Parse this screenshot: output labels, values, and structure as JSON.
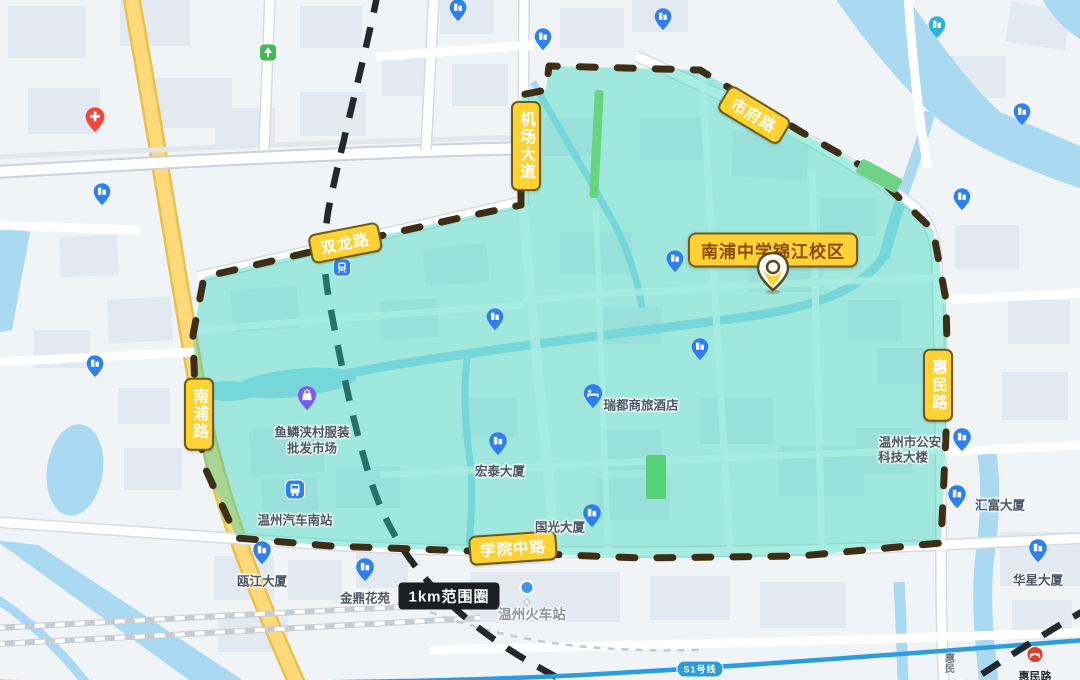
{
  "school": {
    "label": "南浦中学锦江校区"
  },
  "radius": {
    "label": "1km范围圈"
  },
  "roads": {
    "shuanglong": "双龙路",
    "jichang_dadao": "机场大道",
    "shifu": "市府路",
    "nanpu": "南浦路",
    "huimin": "惠民路",
    "xueyuan_zhong": "学院中路"
  },
  "pois": {
    "market_line1": "鱼鳞浃村服装",
    "market_line2": "批发市场",
    "bus_station": "温州汽车南站",
    "hotel": "瑞都商旅酒店",
    "hongtai": "宏泰大厦",
    "guoguang": "国光大厦",
    "police_line1": "温州市公安",
    "police_line2": "科技大楼",
    "huifu": "汇富大厦",
    "huaxing": "华星大厦",
    "oujiang": "瓯江大厦",
    "jinding": "金鼎花苑",
    "train_station": "温州火车站"
  },
  "transit": {
    "s1_line": "S1号线",
    "huimin_station": "惠民路",
    "huimin_road_text": "惠民"
  },
  "icons": {
    "school_marker": "yellow-location-pin",
    "hospital": "red-cross-pin",
    "hotel": "bed-pin",
    "market": "shopping-bag-pin",
    "bus_station": "bus-square",
    "building": "building-pin",
    "park": "tree-square",
    "metro_station": "red-metro-logo",
    "train_station": "blue-dot"
  },
  "colors": {
    "highlight_fill": "#2fd4ba",
    "boundary_dash": "#3d2e15",
    "badge_bg": "#ffd234",
    "badge_border": "#6e5a14",
    "water": "#aad9f2",
    "road_yellow": "#ffd977",
    "metro_blue": "#2a9ce0",
    "poi_blue": "#2e7ff0"
  }
}
